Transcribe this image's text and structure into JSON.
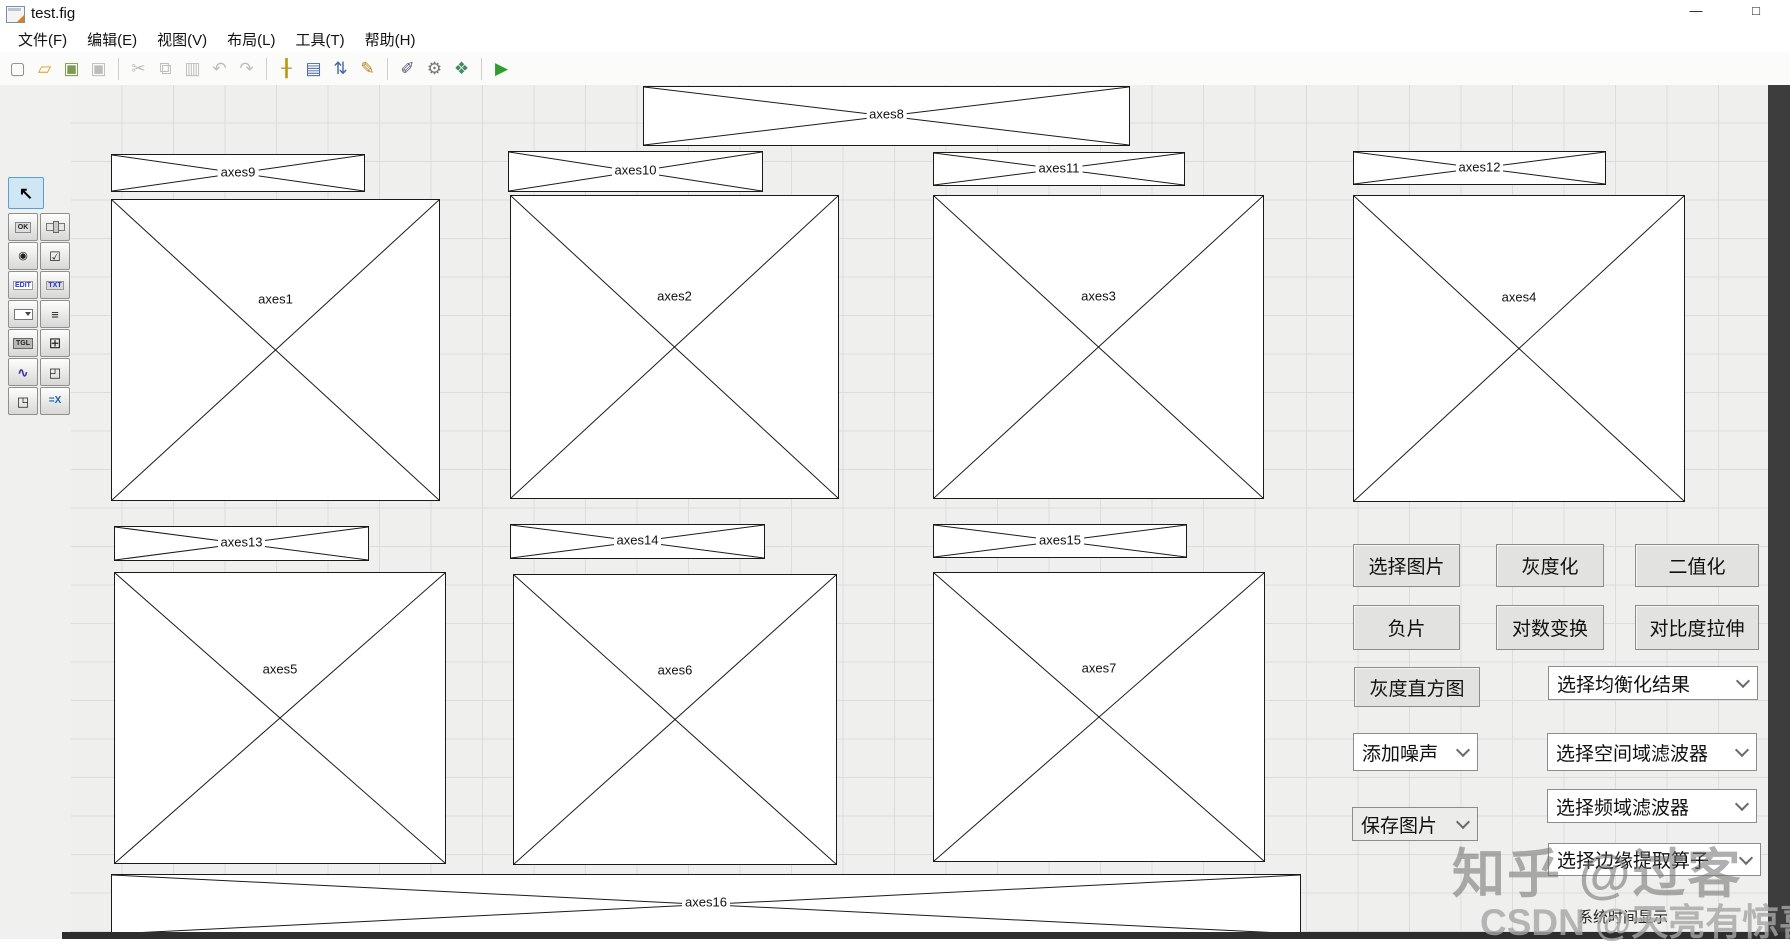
{
  "window": {
    "title": "test.fig",
    "minimize_glyph": "—",
    "maximize_glyph": "□"
  },
  "menu": {
    "items": [
      "文件(F)",
      "编辑(E)",
      "视图(V)",
      "布局(L)",
      "工具(T)",
      "帮助(H)"
    ]
  },
  "toolbar": {
    "icons": [
      {
        "name": "new-file",
        "glyph": "▢",
        "color": "#8a8a88"
      },
      {
        "name": "open-file",
        "glyph": "▱",
        "color": "#d9a21b"
      },
      {
        "name": "save",
        "glyph": "▣",
        "color": "#7a9c4e"
      },
      {
        "name": "save-as",
        "glyph": "▣",
        "color": "#bdbdbb",
        "disabled": true
      },
      {
        "sep": true
      },
      {
        "name": "cut",
        "glyph": "✂",
        "color": "#bdbdbb",
        "disabled": true
      },
      {
        "name": "copy",
        "glyph": "⧉",
        "color": "#bdbdbb",
        "disabled": true
      },
      {
        "name": "paste",
        "glyph": "▥",
        "color": "#bdbdbb",
        "disabled": true
      },
      {
        "name": "undo",
        "glyph": "↶",
        "color": "#bdbdbb",
        "disabled": true
      },
      {
        "name": "redo",
        "glyph": "↷",
        "color": "#bdbdbb",
        "disabled": true
      },
      {
        "sep": true
      },
      {
        "name": "align-objects",
        "glyph": "╂",
        "color": "#b99a1e"
      },
      {
        "name": "menu-editor",
        "glyph": "▤",
        "color": "#4466aa"
      },
      {
        "name": "tab-order-editor",
        "glyph": "⇅",
        "color": "#4466aa"
      },
      {
        "name": "toolbar-editor",
        "glyph": "✎",
        "color": "#b9831e"
      },
      {
        "sep": true
      },
      {
        "name": "m-file-editor",
        "glyph": "✐",
        "color": "#555577"
      },
      {
        "name": "property-inspector",
        "glyph": "⚙",
        "color": "#777775"
      },
      {
        "name": "object-browser",
        "glyph": "❖",
        "color": "#448866"
      },
      {
        "sep": true
      },
      {
        "name": "run-figure",
        "glyph": "▶",
        "color": "#2f9e2f"
      }
    ]
  },
  "palette": {
    "tools": [
      {
        "name": "select-tool",
        "glyph": "↖",
        "selected": true
      },
      {
        "name": "pushbutton",
        "glyph": "OK"
      },
      {
        "name": "slider",
        "glyph": ""
      },
      {
        "name": "radiobutton",
        "glyph": "◉"
      },
      {
        "name": "checkbox",
        "glyph": "☑"
      },
      {
        "name": "edittext",
        "glyph": "EDIT"
      },
      {
        "name": "statictext",
        "glyph": "TXT"
      },
      {
        "name": "popupmenu",
        "glyph": ""
      },
      {
        "name": "listbox",
        "glyph": "≡"
      },
      {
        "name": "togglebutton",
        "glyph": "TGL"
      },
      {
        "name": "table",
        "glyph": "⊞"
      },
      {
        "name": "axes",
        "glyph": "∿"
      },
      {
        "name": "panel",
        "glyph": "◰"
      },
      {
        "name": "buttongroup",
        "glyph": "◳"
      },
      {
        "name": "activex",
        "glyph": "=X"
      }
    ]
  },
  "canvas": {
    "axes": [
      {
        "id": "axes8",
        "label": "axes8",
        "x": 643,
        "y": 86,
        "w": 487,
        "h": 60
      },
      {
        "id": "axes9",
        "label": "axes9",
        "x": 111,
        "y": 154,
        "w": 254,
        "h": 38
      },
      {
        "id": "axes10",
        "label": "axes10",
        "x": 508,
        "y": 151,
        "w": 255,
        "h": 41
      },
      {
        "id": "axes11",
        "label": "axes11",
        "x": 933,
        "y": 152,
        "w": 252,
        "h": 34
      },
      {
        "id": "axes12",
        "label": "axes12",
        "x": 1353,
        "y": 151,
        "w": 253,
        "h": 34
      },
      {
        "id": "axes1",
        "label": "axes1",
        "x": 111,
        "y": 199,
        "w": 329,
        "h": 302
      },
      {
        "id": "axes2",
        "label": "axes2",
        "x": 510,
        "y": 195,
        "w": 329,
        "h": 304
      },
      {
        "id": "axes3",
        "label": "axes3",
        "x": 933,
        "y": 195,
        "w": 331,
        "h": 304
      },
      {
        "id": "axes4",
        "label": "axes4",
        "x": 1353,
        "y": 195,
        "w": 332,
        "h": 307
      },
      {
        "id": "axes13",
        "label": "axes13",
        "x": 114,
        "y": 526,
        "w": 255,
        "h": 35
      },
      {
        "id": "axes14",
        "label": "axes14",
        "x": 510,
        "y": 524,
        "w": 255,
        "h": 35
      },
      {
        "id": "axes15",
        "label": "axes15",
        "x": 933,
        "y": 524,
        "w": 254,
        "h": 34
      },
      {
        "id": "axes5",
        "label": "axes5",
        "x": 114,
        "y": 572,
        "w": 332,
        "h": 292
      },
      {
        "id": "axes6",
        "label": "axes6",
        "x": 513,
        "y": 574,
        "w": 324,
        "h": 291
      },
      {
        "id": "axes7",
        "label": "axes7",
        "x": 933,
        "y": 572,
        "w": 332,
        "h": 290
      },
      {
        "id": "axes16",
        "label": "axes16",
        "x": 111,
        "y": 874,
        "w": 1190,
        "h": 61
      }
    ]
  },
  "controls": {
    "buttons": [
      {
        "name": "select-image",
        "label": "选择图片",
        "x": 1353,
        "y": 544,
        "w": 107,
        "h": 43
      },
      {
        "name": "grayscale",
        "label": "灰度化",
        "x": 1496,
        "y": 544,
        "w": 108,
        "h": 43
      },
      {
        "name": "binarize",
        "label": "二值化",
        "x": 1635,
        "y": 544,
        "w": 124,
        "h": 43
      },
      {
        "name": "negative",
        "label": "负片",
        "x": 1353,
        "y": 605,
        "w": 107,
        "h": 45
      },
      {
        "name": "log-transform",
        "label": "对数变换",
        "x": 1496,
        "y": 605,
        "w": 108,
        "h": 45
      },
      {
        "name": "contrast-stretch",
        "label": "对比度拉伸",
        "x": 1635,
        "y": 605,
        "w": 124,
        "h": 45
      },
      {
        "name": "gray-histogram",
        "label": "灰度直方图",
        "x": 1354,
        "y": 667,
        "w": 126,
        "h": 40
      }
    ],
    "dropdowns": [
      {
        "name": "equalization-result-select",
        "label": "选择均衡化结果",
        "x": 1548,
        "y": 666,
        "w": 210,
        "h": 34,
        "bg": "#ffffff"
      },
      {
        "name": "add-noise-select",
        "label": "添加噪声",
        "x": 1353,
        "y": 733,
        "w": 125,
        "h": 38,
        "bg": "#ffffff"
      },
      {
        "name": "spatial-filter-select",
        "label": "选择空间域滤波器",
        "x": 1547,
        "y": 733,
        "w": 210,
        "h": 38,
        "bg": "#ffffff"
      },
      {
        "name": "save-image-select",
        "label": "保存图片",
        "x": 1352,
        "y": 807,
        "w": 126,
        "h": 34,
        "bg": "#ececea"
      },
      {
        "name": "frequency-filter-select",
        "label": "选择频域滤波器",
        "x": 1547,
        "y": 789,
        "w": 210,
        "h": 34,
        "bg": "#ffffff"
      },
      {
        "name": "edge-operator-select",
        "label": "选择边缘提取算子",
        "x": 1548,
        "y": 843,
        "w": 213,
        "h": 33,
        "bg": "#ffffff"
      }
    ],
    "static_text": {
      "label": "系统时间显示"
    }
  },
  "watermarks": {
    "zhihu": "知乎 @过客",
    "csdn": "CSDN @天亮有惊喜"
  },
  "colors": {
    "canvas_bg": "#efefed",
    "grid_line": "#dcdcda",
    "button_bg": "#e2e2e0",
    "selection_blue": "#cfe7f5",
    "run_green": "#2f9e2f",
    "desktop_dark": "#3d3d3d"
  }
}
